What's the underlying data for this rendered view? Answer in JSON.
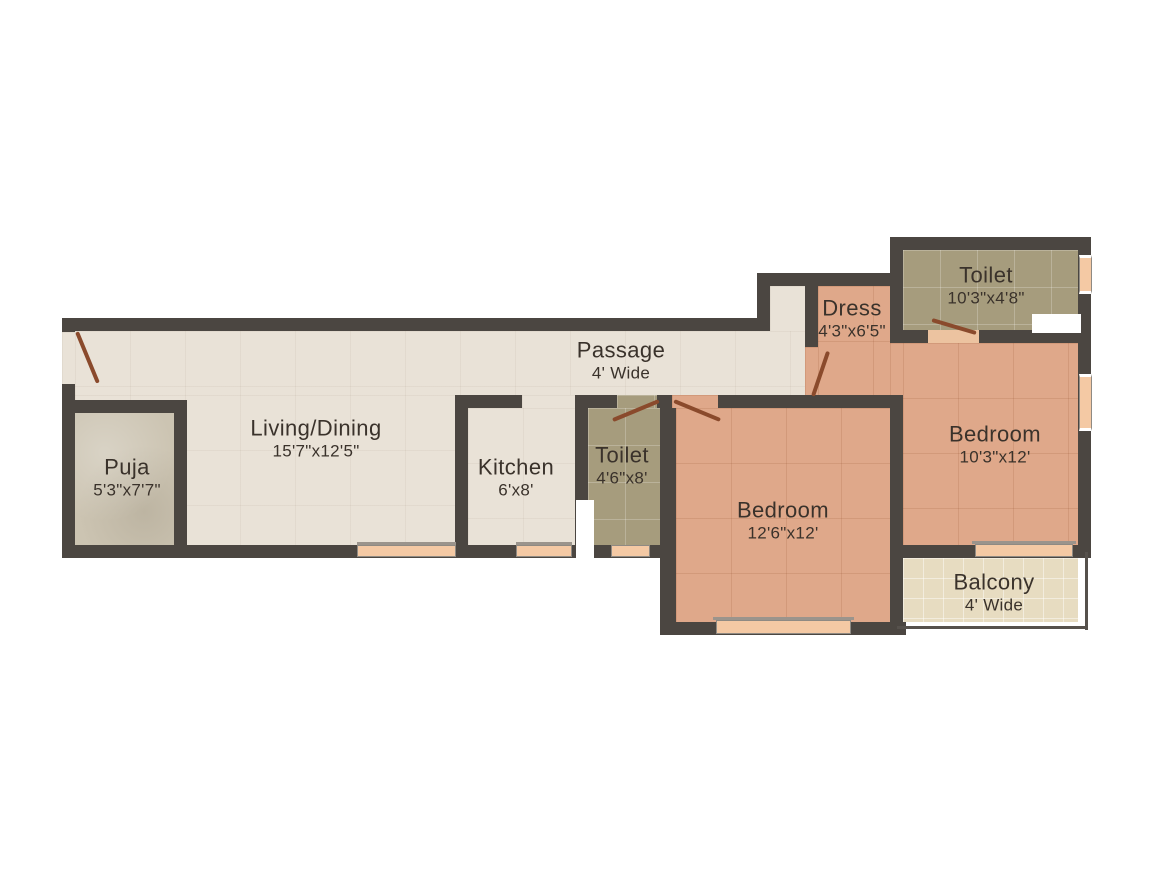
{
  "plan": {
    "title": "2 BHK apartment floor plan",
    "colors": {
      "wall": "#4b4641",
      "floor_common": "#e9e2d7",
      "floor_puja": "#ccc4b2",
      "floor_toilet": "#a69c7d",
      "floor_bedroom": "#dfa88a",
      "floor_balcony": "#e7dcc1",
      "window": "#f4c9a4",
      "door": "#8a4a2c",
      "text": "#3a322b",
      "background": "#ffffff"
    },
    "rooms": [
      {
        "id": "living",
        "name": "Living/Dining",
        "dims": "15'7\"x12'5\""
      },
      {
        "id": "puja",
        "name": "Puja",
        "dims": "5'3\"x7'7\""
      },
      {
        "id": "kitchen",
        "name": "Kitchen",
        "dims": "6'x8'"
      },
      {
        "id": "toilet1",
        "name": "Toilet",
        "dims": "4'6\"x8'"
      },
      {
        "id": "passage",
        "name": "Passage",
        "dims": "4' Wide"
      },
      {
        "id": "bedroom1",
        "name": "Bedroom",
        "dims": "12'6\"x12'"
      },
      {
        "id": "dress",
        "name": "Dress",
        "dims": "4'3\"x6'5\""
      },
      {
        "id": "toilet2",
        "name": "Toilet",
        "dims": "10'3\"x4'8\""
      },
      {
        "id": "bedroom2",
        "name": "Bedroom",
        "dims": "10'3\"x12'"
      },
      {
        "id": "balcony",
        "name": "Balcony",
        "dims": "4' Wide"
      }
    ]
  }
}
